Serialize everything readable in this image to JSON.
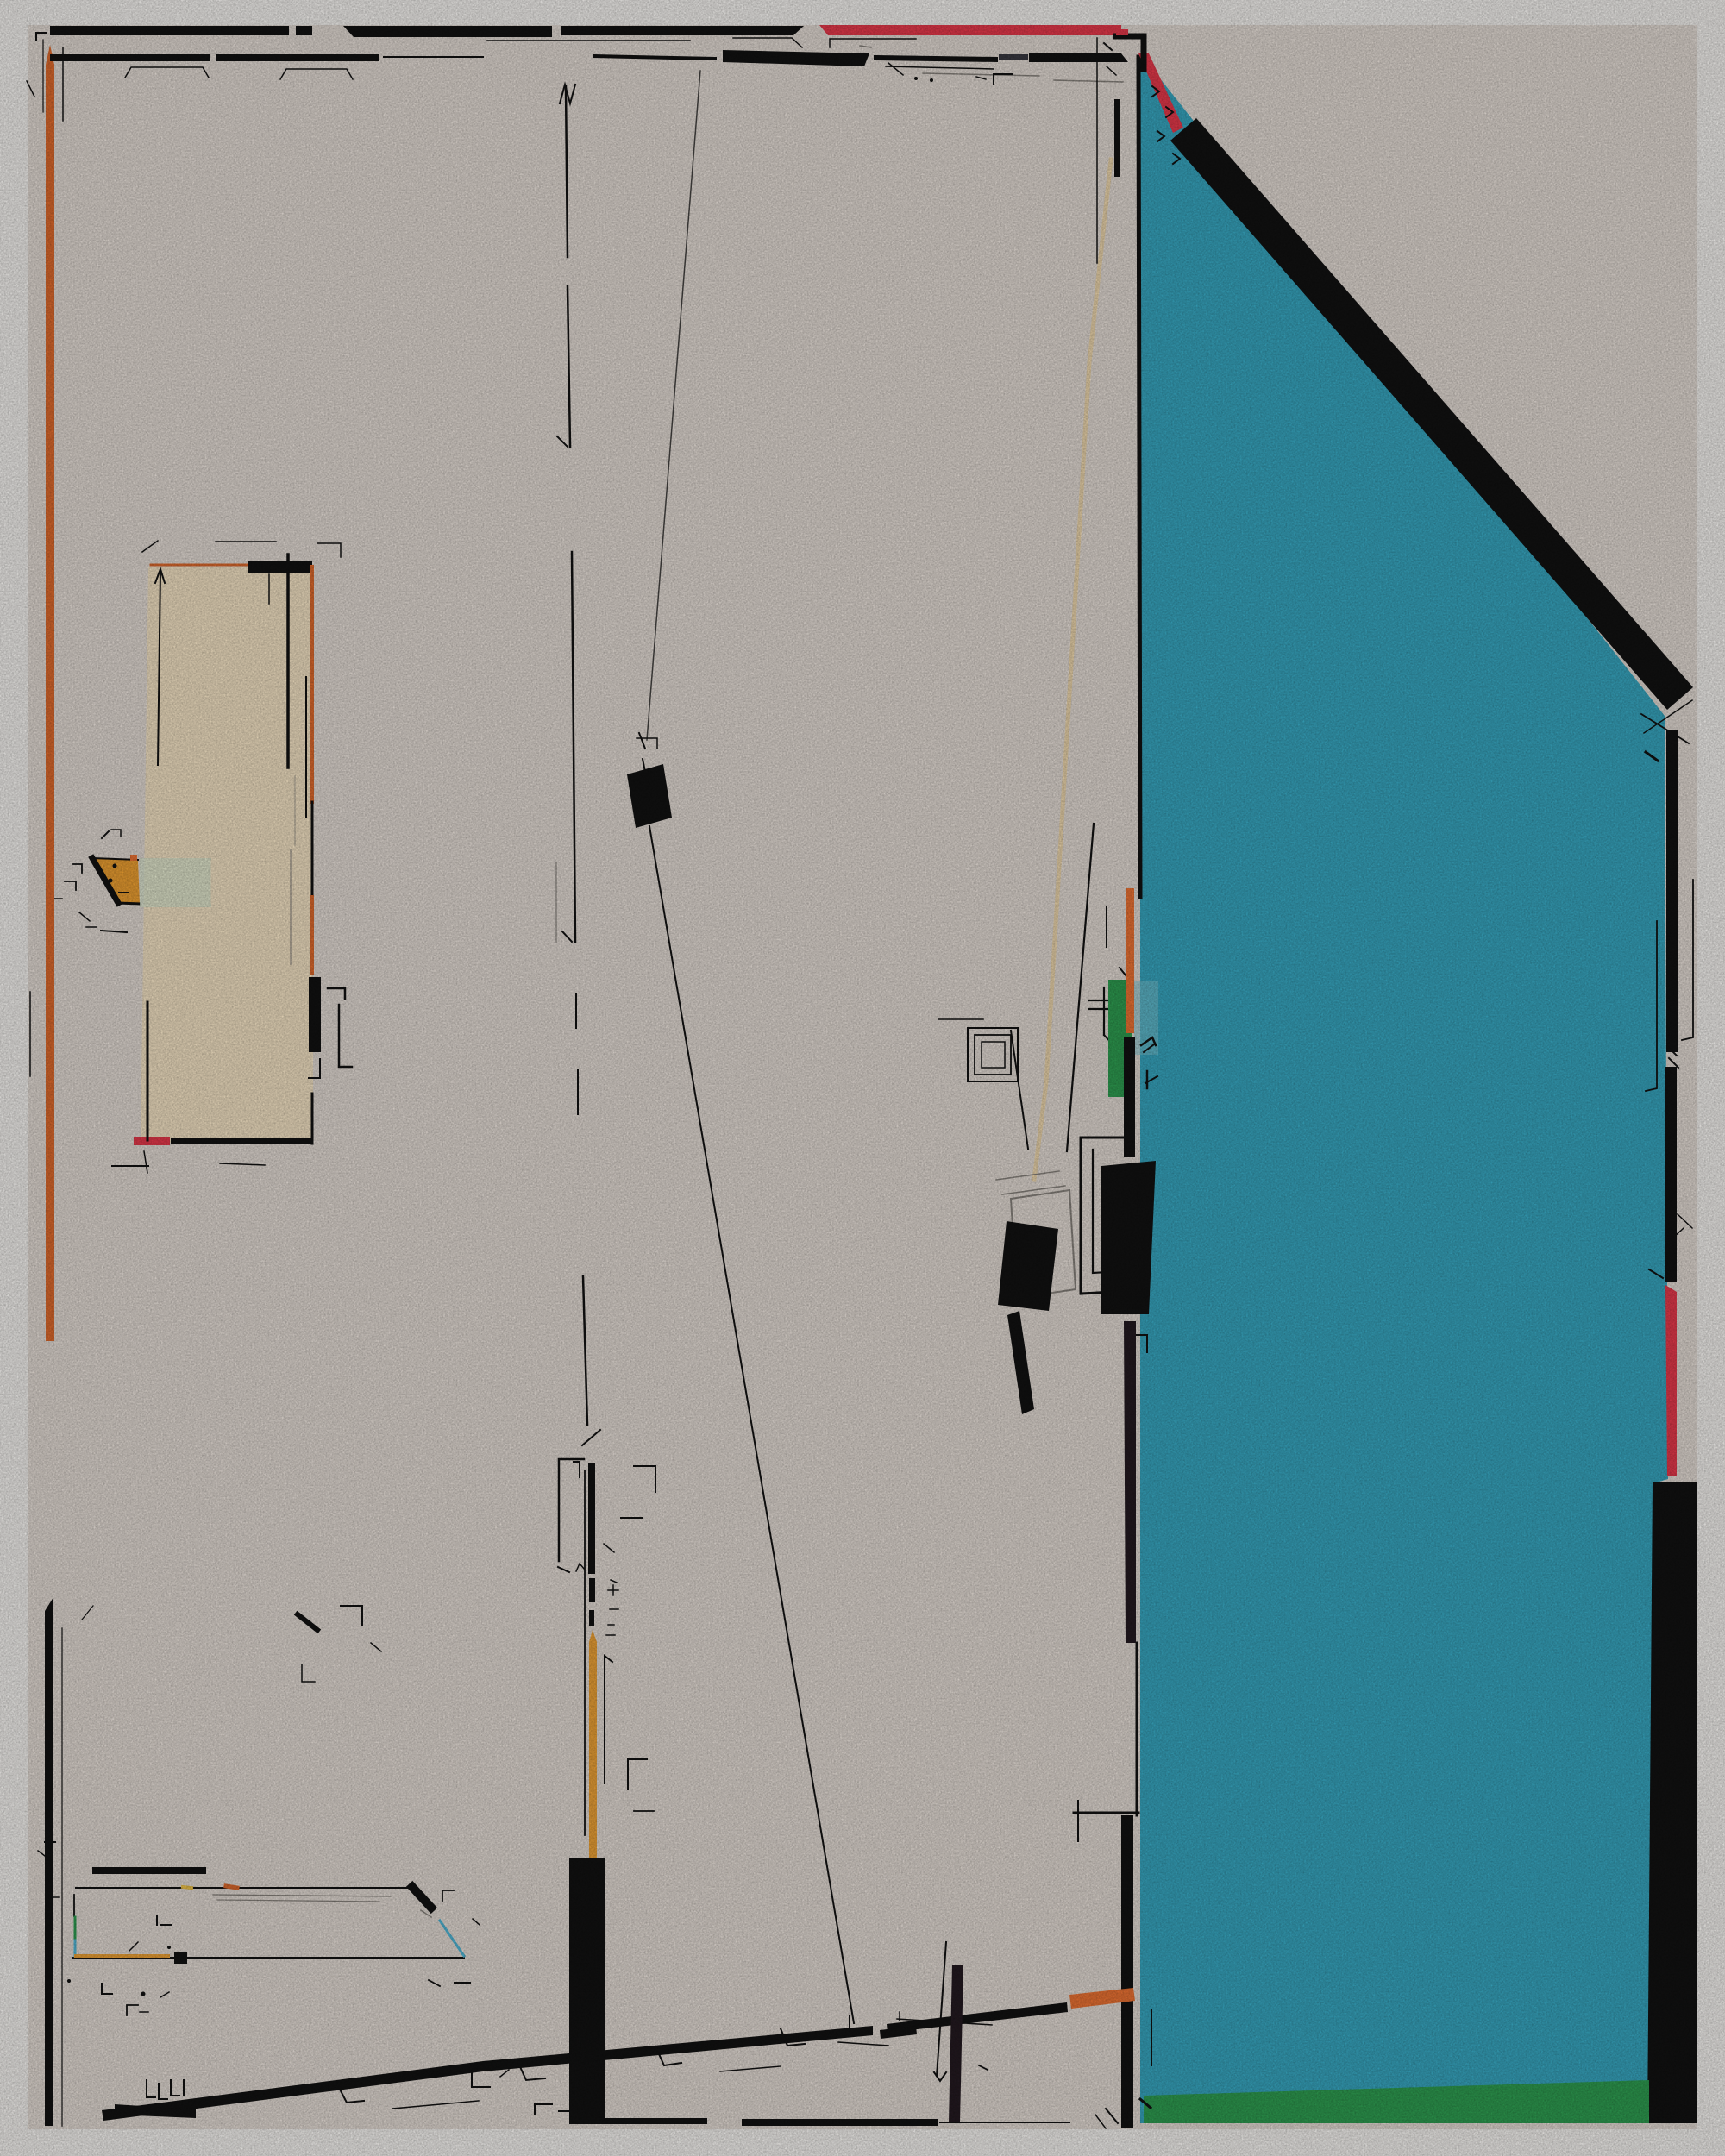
{
  "artwork": {
    "kind": "abstract-generative-composition",
    "visible_text": ""
  },
  "palette": {
    "background_white": "#f7f5f2",
    "panel_cream": "#e6ded7",
    "ink_black": "#121212",
    "accent_red": "#e93a4c",
    "accent_orange": "#e06b2d",
    "accent_orange_bright": "#ef7434",
    "accent_gold": "#f0a437",
    "trapezoid_orange": "#efa132",
    "teal_main": "#38a8c2",
    "teal_light": "#7cc4d4",
    "green_main": "#2f9f52",
    "pale_green": "#dbe7cf",
    "beige_panel": "#f6e5c6",
    "peach_line": "#f0d7a7",
    "cyan_line": "#52b8d8",
    "gray_line": "#8a857f",
    "dark_gray": "#3a3a42",
    "dark_maroon": "#241a21",
    "yellow_dash": "#edc24a"
  }
}
